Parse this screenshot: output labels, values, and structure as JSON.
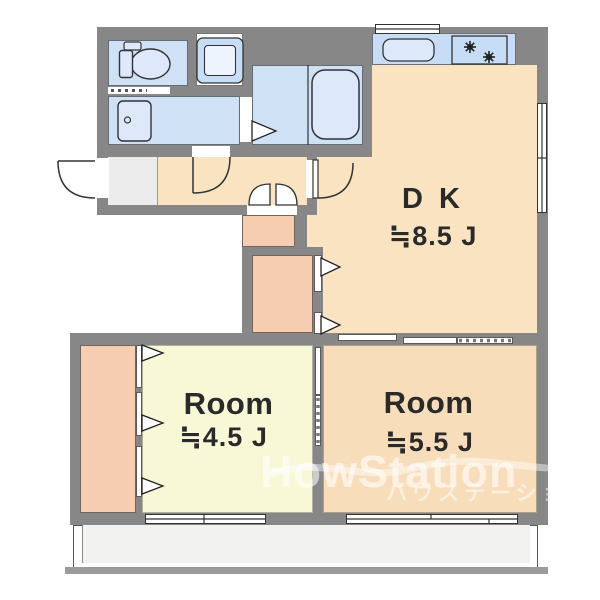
{
  "plan": {
    "rooms": {
      "dk": {
        "label": "D K",
        "size": "≒8.5 J"
      },
      "room_45": {
        "label": "Room",
        "size": "≒4.5 J"
      },
      "room_55": {
        "label": "Room",
        "size": "≒5.5 J"
      }
    },
    "fixtures": {
      "toilet": "toilet-icon",
      "washing_machine": "washing-machine-pan-icon",
      "washbasin": "washbasin-icon",
      "bathtub": "bathtub-icon",
      "kitchen_sink": "kitchen-sink-icon",
      "stove": "gas-stove-burners-icon"
    }
  },
  "watermark": {
    "brand": "HowStation",
    "subtitle": "ハウステーション 中央"
  },
  "colors": {
    "wall": "#878787",
    "dk_floor": "#f9e3c1",
    "room45_floor": "#f8f8d7",
    "room55_floor": "#f8ddba",
    "closet_fill": "#f6cdb0",
    "wet_room": "#cfe1f5",
    "fixture_fill": "#dde9fb",
    "counter_fill": "#c7ddf5",
    "genkan_fill": "#ececec",
    "balcony_fill": "#f2f2f0",
    "label_text": "#2a2a2a"
  }
}
